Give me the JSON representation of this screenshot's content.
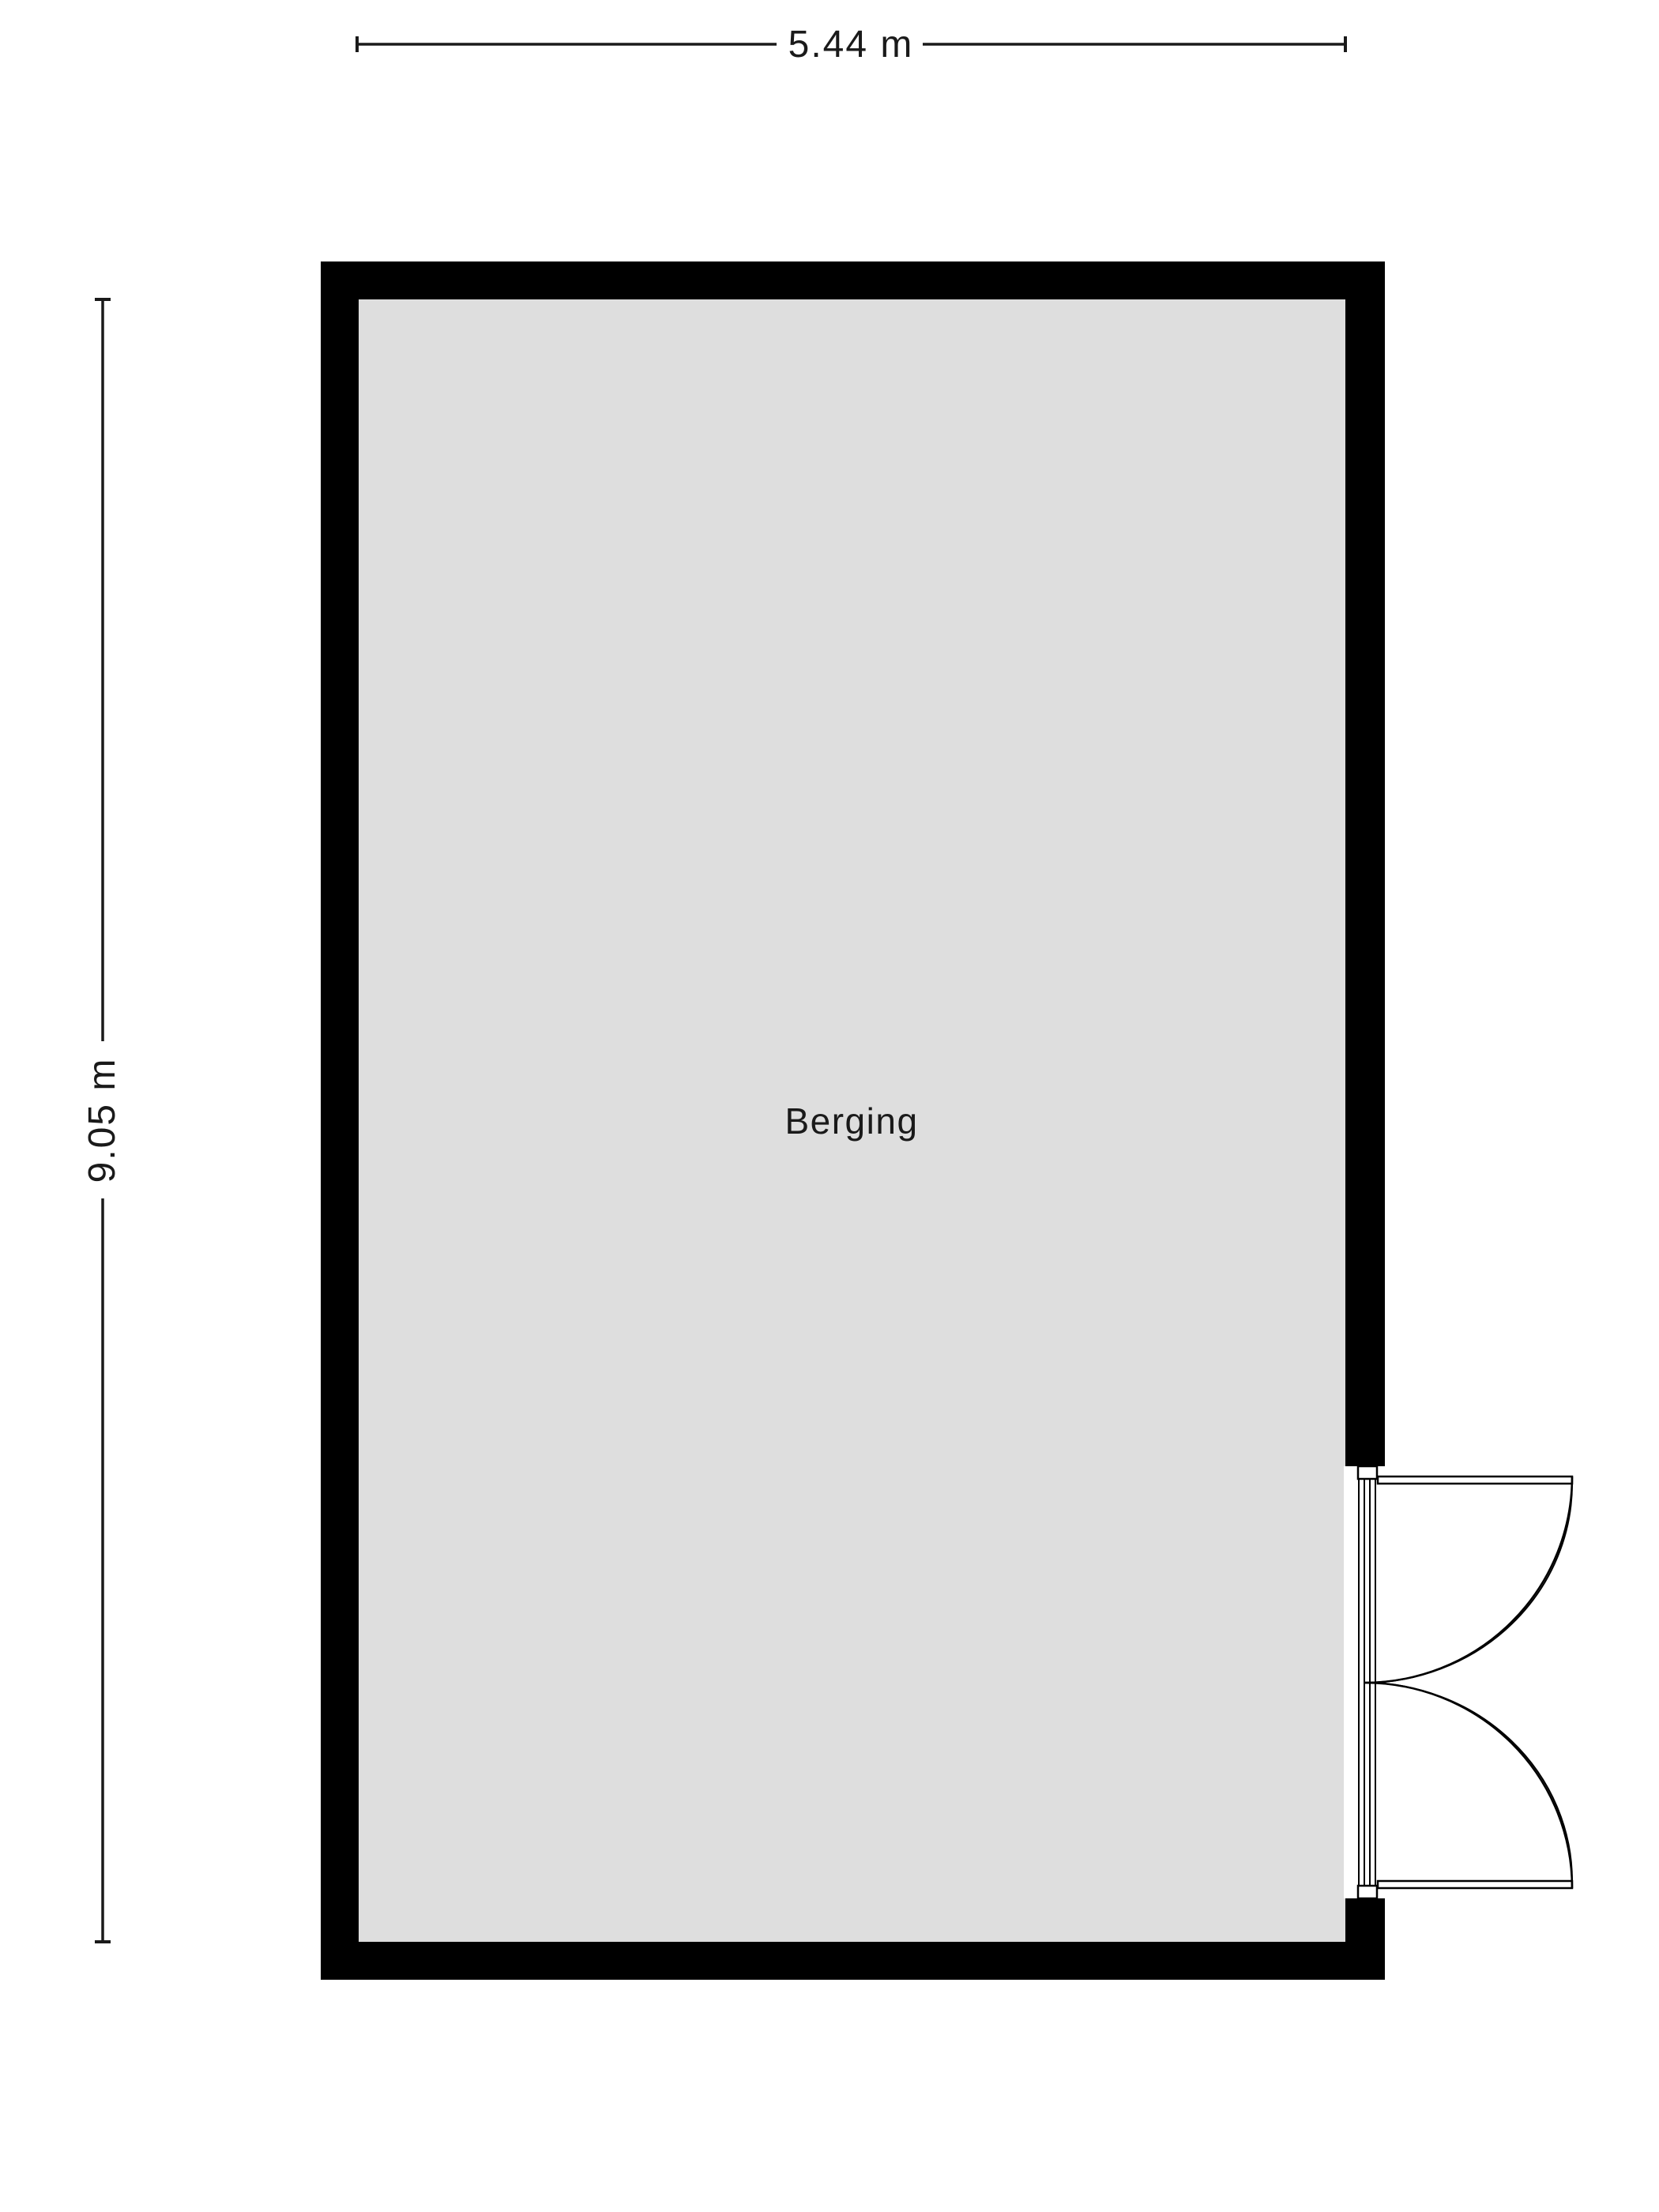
{
  "floorplan": {
    "room_label": "Berging",
    "dimensions": {
      "width_label": "5.44 m",
      "height_label": "9.05 m"
    },
    "colors": {
      "wall": "#000000",
      "floor": "#dedede",
      "line": "#1a1a1a",
      "background": "#ffffff"
    }
  }
}
